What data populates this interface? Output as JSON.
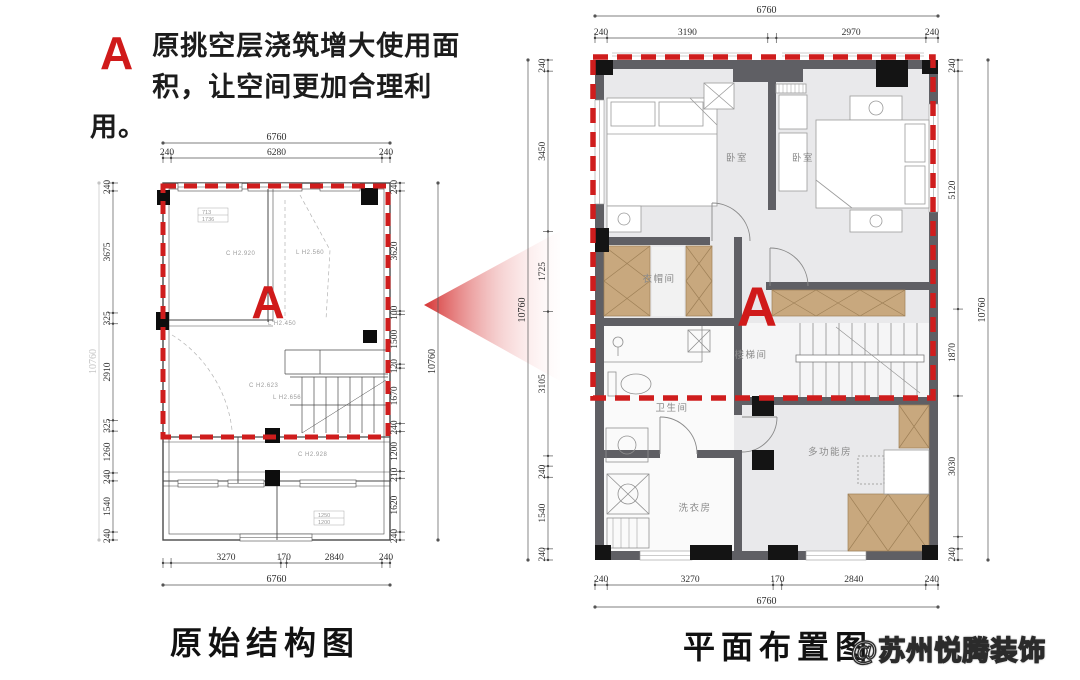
{
  "annotation": {
    "marker": "A",
    "text": "原挑空层浇筑增大使用面积，让空间更加合理利用。"
  },
  "titles": {
    "left": "原始结构图",
    "right": "平面布置图"
  },
  "watermark": "@苏州悦腾装饰",
  "colors": {
    "accent_red": "#d01a1a",
    "wall_gray": "#5f5f64",
    "floor_gray": "#e9e9eb",
    "wood_tan": "#c8a87e"
  },
  "left_plan": {
    "marker": "A",
    "notes": [
      "C H2.920",
      "L H2.560",
      "L H2.450",
      "C H2.623",
      "L H2.656",
      "C H2.928"
    ],
    "note_boxes": [
      {
        "line1": "713",
        "line2": "1736"
      },
      {
        "line1": "1250",
        "line2": "1200"
      }
    ],
    "dims": {
      "top_total": "6760",
      "top_chain": {
        "values": [
          240,
          6280,
          240
        ],
        "labels": [
          "240",
          "6280",
          "240"
        ]
      },
      "left_chain": {
        "values": [
          240,
          3675,
          325,
          2910,
          325,
          1260,
          240,
          1540,
          240
        ],
        "labels": [
          "240",
          "3675",
          "325",
          "2910",
          "325",
          "1260",
          "240",
          "1540",
          "240"
        ]
      },
      "left_total": "10760",
      "right_chain": {
        "values": [
          240,
          3620,
          100,
          1500,
          120,
          1670,
          240,
          1200,
          210,
          1620,
          240
        ],
        "labels": [
          "240",
          "3620",
          "100",
          "1500",
          "120",
          "1670",
          "240",
          "1200",
          "210",
          "1620",
          "240"
        ]
      },
      "right_total": "10760",
      "bottom_chain": {
        "values": [
          240,
          3270,
          170,
          2840,
          240
        ],
        "labels": [
          "",
          "3270",
          "170",
          "2840",
          "240"
        ]
      },
      "bottom_total": "6760"
    }
  },
  "right_plan": {
    "marker": "A",
    "rooms": [
      "卧室",
      "卧室",
      "衣帽间",
      "楼梯间",
      "卫生间",
      "多功能房",
      "洗衣房"
    ],
    "dims": {
      "top_total": "6760",
      "top_chain": {
        "values": [
          240,
          3190,
          170,
          2970,
          240
        ],
        "labels": [
          "240",
          "3190",
          "",
          "2970",
          "240"
        ]
      },
      "left_chain": {
        "values": [
          240,
          3450,
          1725,
          3105,
          220,
          240,
          1540,
          240
        ],
        "labels": [
          "240",
          "3450",
          "1725",
          "3105",
          "",
          "240",
          "1540",
          "240"
        ]
      },
      "left_total": "10760",
      "right_chain": {
        "values": [
          240,
          5120,
          1870,
          3030,
          260,
          240
        ],
        "labels": [
          "240",
          "5120",
          "1870",
          "3030",
          "",
          "240"
        ]
      },
      "right_total": "10760",
      "bottom_chain": {
        "values": [
          240,
          3270,
          170,
          2840,
          240
        ],
        "labels": [
          "240",
          "3270",
          "170",
          "2840",
          "240"
        ]
      },
      "bottom_total": "6760"
    }
  }
}
